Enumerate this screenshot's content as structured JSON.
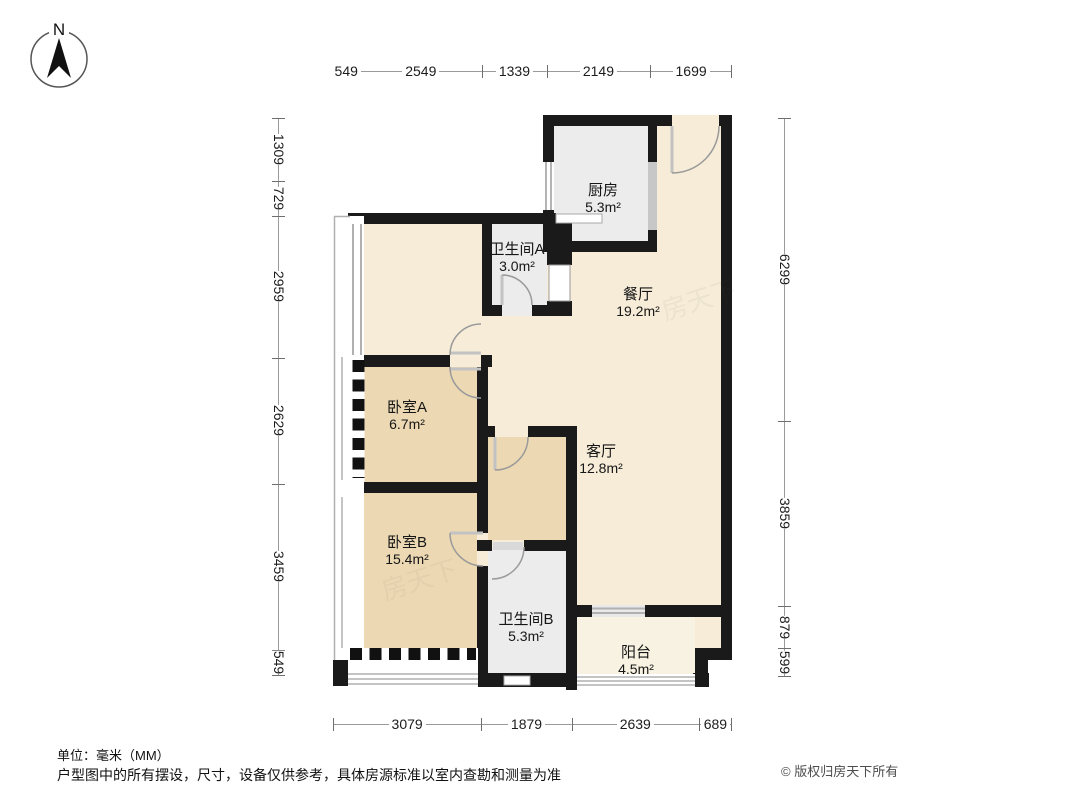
{
  "compass": {
    "label": "N"
  },
  "plan": {
    "rooms": [
      {
        "name": "厨房",
        "area": "5.3m²"
      },
      {
        "name": "卫生间A",
        "area": "3.0m²"
      },
      {
        "name": "餐厅",
        "area": "19.2m²"
      },
      {
        "name": "卧室A",
        "area": "6.7m²"
      },
      {
        "name": "客厅",
        "area": "12.8m²"
      },
      {
        "name": "卧室B",
        "area": "15.4m²"
      },
      {
        "name": "卫生间B",
        "area": "5.3m²"
      },
      {
        "name": "阳台",
        "area": "4.5m²"
      }
    ],
    "watermark": "房天下"
  },
  "dimensions": {
    "top": [
      "549",
      "2549",
      "1339",
      "2149",
      "1699"
    ],
    "bottom": [
      "3079",
      "1879",
      "2639",
      "689"
    ],
    "left": [
      "1309",
      "729",
      "2959",
      "2629",
      "3459",
      "549"
    ],
    "right": [
      "6299",
      "3859",
      "879",
      "599"
    ]
  },
  "footer": {
    "unit": "单位：毫米（MM）",
    "disclaimer": "户型图中的所有摆设，尺寸，设备仅供参考，具体房源标准以室内查勘和测量为准",
    "copyright": "© 版权归房天下所有"
  },
  "colors": {
    "wall": "#1a1a1a",
    "room_cream": "#f6ecd8",
    "room_tan": "#ecd9b4",
    "room_gray": "#ececec",
    "balcony": "#f8f2e2",
    "dim_line": "#9a9a9a"
  }
}
